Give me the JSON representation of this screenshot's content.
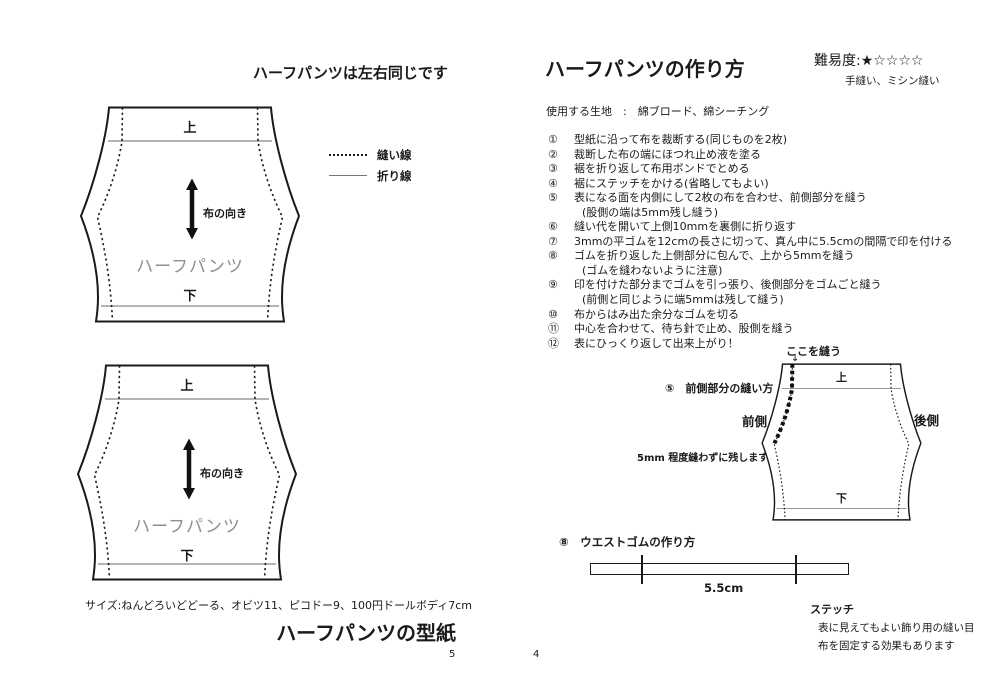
{
  "colors": {
    "text": "#1a1a1a",
    "muted_label": "#8f8f8f",
    "fold_line": "#888888"
  },
  "left_page": {
    "note_top": "ハーフパンツは左右同じです",
    "legend": {
      "sew_line": "縫い線",
      "fold_line": "折り線"
    },
    "patterns": [
      {
        "top_label": "上",
        "grain_label": "布の向き",
        "name_label": "ハーフパンツ",
        "bottom_label": "下"
      },
      {
        "top_label": "上",
        "grain_label": "布の向き",
        "name_label": "ハーフパンツ",
        "bottom_label": "下"
      }
    ],
    "size_note": "サイズ:ねんどろいどどーる、オビツ11、ピコドー9、100円ドールボディ7cm",
    "title": "ハーフパンツの型紙",
    "page_number": "5"
  },
  "right_page": {
    "title": "ハーフパンツの作り方",
    "difficulty_label": "難易度:",
    "difficulty_stars": "★☆☆☆☆",
    "sewing_methods": "手縫い、ミシン縫い",
    "fabric_line": "使用する生地　:　綿ブロード、綿シーチング",
    "steps": [
      {
        "num": "①",
        "text": "型紙に沿って布を裁断する(同じものを2枚)"
      },
      {
        "num": "②",
        "text": "裁断した布の端にほつれ止め液を塗る"
      },
      {
        "num": "③",
        "text": "裾を折り返して布用ボンドでとめる"
      },
      {
        "num": "④",
        "text": "裾にステッチをかける(省略してもよい)"
      },
      {
        "num": "⑤",
        "text": "表になる面を内側にして2枚の布を合わせ、前側部分を縫う",
        "sub": "(股側の端は5mm残し縫う)"
      },
      {
        "num": "⑥",
        "text": "縫い代を開いて上側10mmを裏側に折り返す"
      },
      {
        "num": "⑦",
        "text": "3mmの平ゴムを12cmの長さに切って、真ん中に5.5cmの間隔で印を付ける"
      },
      {
        "num": "⑧",
        "text": "ゴムを折り返した上側部分に包んで、上から5mmを縫う",
        "sub": "(ゴムを縫わないように注意)"
      },
      {
        "num": "⑨",
        "text": "印を付けた部分までゴムを引っ張り、後側部分をゴムごと縫う",
        "sub": "(前側と同じように端5mmは残して縫う)"
      },
      {
        "num": "⑩",
        "text": "布からはみ出た余分なゴムを切る"
      },
      {
        "num": "⑪",
        "text": "中心を合わせて、待ち針で止め、股側を縫う"
      },
      {
        "num": "⑫",
        "text": "表にひっくり返して出来上がり！"
      }
    ],
    "front_sew_diagram": {
      "sew_here": "ここを縫う",
      "arrow_down": "↓",
      "caption": "⑤　前側部分の縫い方",
      "front_label": "前側",
      "back_label": "後側",
      "top_label": "上",
      "bottom_label": "下",
      "leave_note": "5mm 程度縫わずに残します　→"
    },
    "elastic_diagram": {
      "caption": "⑧　ウエストゴムの作り方",
      "length_label": "5.5cm"
    },
    "stitch_note": {
      "title": "ステッチ",
      "line1": "表に見えてもよい飾り用の縫い目",
      "line2": "布を固定する効果もあります"
    },
    "page_number": "4"
  }
}
